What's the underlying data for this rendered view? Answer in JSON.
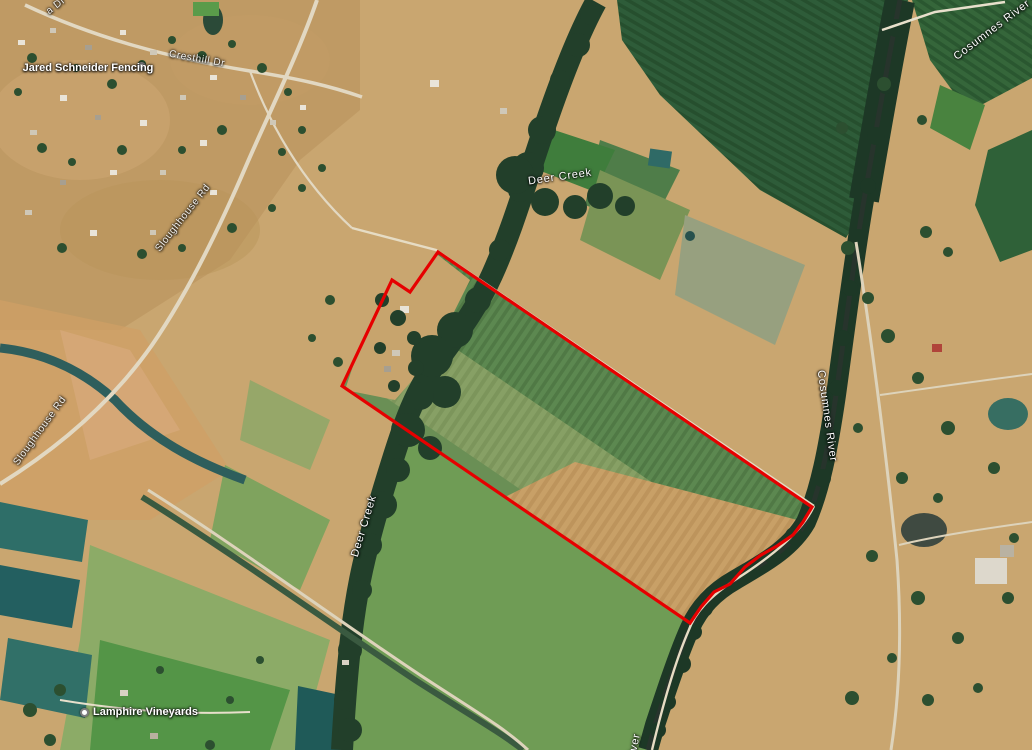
{
  "map": {
    "view": "satellite",
    "boundary": {
      "color": "#e60000",
      "stroke_width": 3.2,
      "points": [
        [
          438,
          252
        ],
        [
          812,
          507
        ],
        [
          803,
          522
        ],
        [
          793,
          535
        ],
        [
          777,
          546
        ],
        [
          761,
          555
        ],
        [
          745,
          567
        ],
        [
          730,
          584
        ],
        [
          714,
          592
        ],
        [
          701,
          607
        ],
        [
          690,
          623
        ],
        [
          342,
          386
        ],
        [
          392,
          280
        ],
        [
          410,
          292
        ]
      ]
    },
    "labels": {
      "partial_road_top_left": "a Dr",
      "cresthill_dr": "Cresthill Dr",
      "sloughhouse_rd_upper": "Sloughhouse Rd",
      "sloughhouse_rd_lower": "Sloughhouse Rd",
      "deer_creek_upper": "Deer Creek",
      "deer_creek_lower": "Deer Creek",
      "cosumnes_river_top": "Cosumnes River",
      "cosumnes_river_mid": "Cosumnes River",
      "cosumnes_river_bottom": "River",
      "poi_jared": "Jared Schneider Fencing",
      "poi_vineyards": "Lamphire Vineyards"
    }
  }
}
